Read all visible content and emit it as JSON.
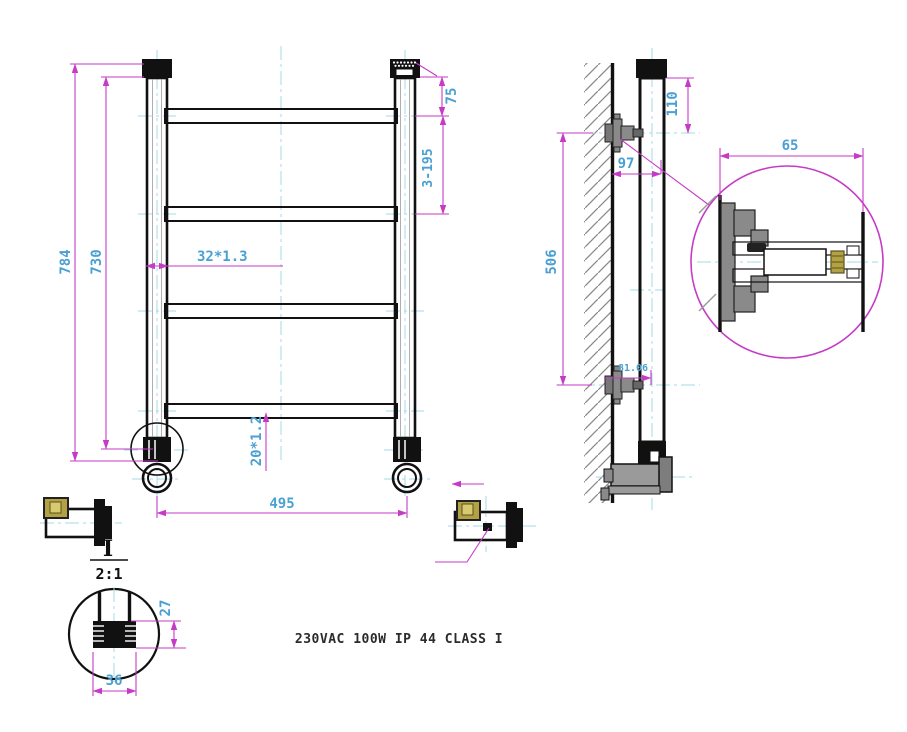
{
  "drawing_title": "Ladder towel radiator technical drawing",
  "spec_text": "230VAC 100W IP 44 CLASS I",
  "front_view": {
    "dim_overall_height": "784",
    "dim_tube_height": "730",
    "dim_top_to_first_rung": "75",
    "dim_rung_spacing": "3-195",
    "dim_vertical_tube": "32*1.3",
    "dim_rung_tube": "20*1.2",
    "dim_width": "495"
  },
  "side_view": {
    "dim_top_offset": "110",
    "dim_wall_distance": "97",
    "dim_bracket_spacing": "506",
    "dim_bottom_offset": "81.06",
    "dim_bracket_length": "65"
  },
  "detail_view": {
    "label": "I",
    "scale": "2:1",
    "dim_fitting_height": "27",
    "dim_fitting_width": "36"
  },
  "colors": {
    "dimension_line": "#c63bc6",
    "dimension_text": "#4aa0d2",
    "centerline": "#a6d9e8",
    "drawing_line": "#111111",
    "brass_fitting": "#b3a144",
    "bracket_gray": "#8a8a8a"
  }
}
